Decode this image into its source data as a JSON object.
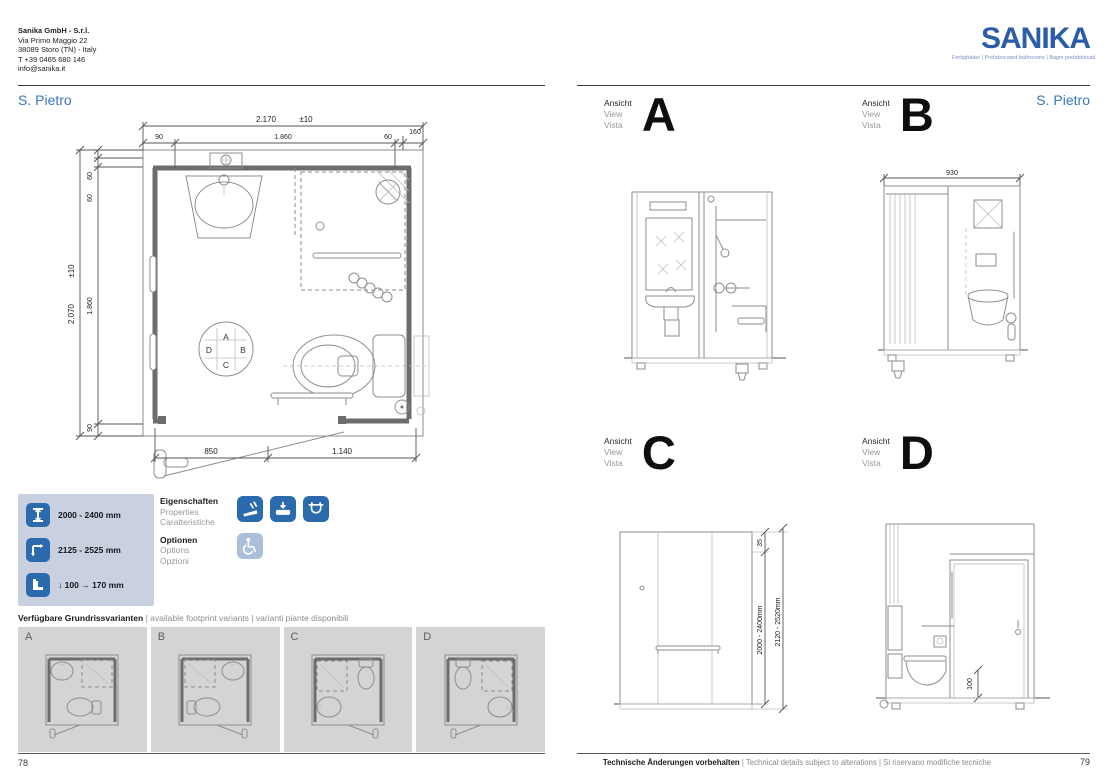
{
  "company": {
    "name": "Sanika GmbH - S.r.l.",
    "address_line1": "Via Primo Maggio 22",
    "address_line2": "38089 Storo (TN) - Italy",
    "phone": "T +39 0465 680 146",
    "email": "info@sanika.it"
  },
  "brand": {
    "logo_text": "SANIKA",
    "tagline": "Fertigbäder | Prefabricated bathrooms | Bagni prefabbricati"
  },
  "page_left": {
    "title": "S. Pietro",
    "page_number": "78",
    "plan_dims": {
      "width_total": "2.170",
      "width_tol": "±10",
      "top_segments": [
        "90",
        "1.860",
        "60",
        "160"
      ],
      "height_total": "2.070",
      "height_tol": "±10",
      "left_segments": [
        "60",
        "60",
        "1.860",
        "90"
      ],
      "bottom_segments": [
        "850",
        "1.140"
      ],
      "orientation": {
        "top": "A",
        "right": "B",
        "bottom": "C",
        "left": "D"
      }
    },
    "legend": {
      "row1_label": "2000 - 2400 mm",
      "row2_label": "2125 - 2525 mm",
      "row3_down_value": "100",
      "row3_right_value": "170 mm",
      "down_arrow": "↓",
      "right_arrow": "→"
    },
    "properties": {
      "de": "Eigenschaften",
      "en": "Properties",
      "it": "Caratteristiche"
    },
    "options": {
      "de": "Optionen",
      "en": "Options",
      "it": "Opzioni"
    },
    "variants_heading": {
      "de": "Verfügbare Grundrissvarianten",
      "en": "available footprint variants",
      "it": "varianti piante disponibili",
      "sep": "|"
    },
    "variants": [
      {
        "label": "A"
      },
      {
        "label": "B"
      },
      {
        "label": "C"
      },
      {
        "label": "D"
      }
    ]
  },
  "page_right": {
    "title": "S. Pietro",
    "page_number": "79",
    "view_label": {
      "de": "Ansicht",
      "en": "View",
      "it": "Vista"
    },
    "views": [
      {
        "letter": "A"
      },
      {
        "letter": "B",
        "dim_width": "930"
      },
      {
        "letter": "C",
        "dim_top": "35",
        "dim_inner": "2000 - 2400mm",
        "dim_outer": "2120 - 2520mm"
      },
      {
        "letter": "D",
        "dim_floor": "100"
      }
    ],
    "footer": {
      "de": "Technische Änderungen vorbehalten",
      "en": "Technical details subject to alterations",
      "it": "Si riservano modifiche tecniche",
      "sep": "|"
    }
  },
  "colors": {
    "brand_blue": "#2a5ca8",
    "title_blue": "#3b77bd",
    "legend_panel": "#c9d1e1",
    "icon_blue": "#2b6aad",
    "icon_light": "#aabfd9",
    "variant_cell": "#d4d4d4"
  }
}
